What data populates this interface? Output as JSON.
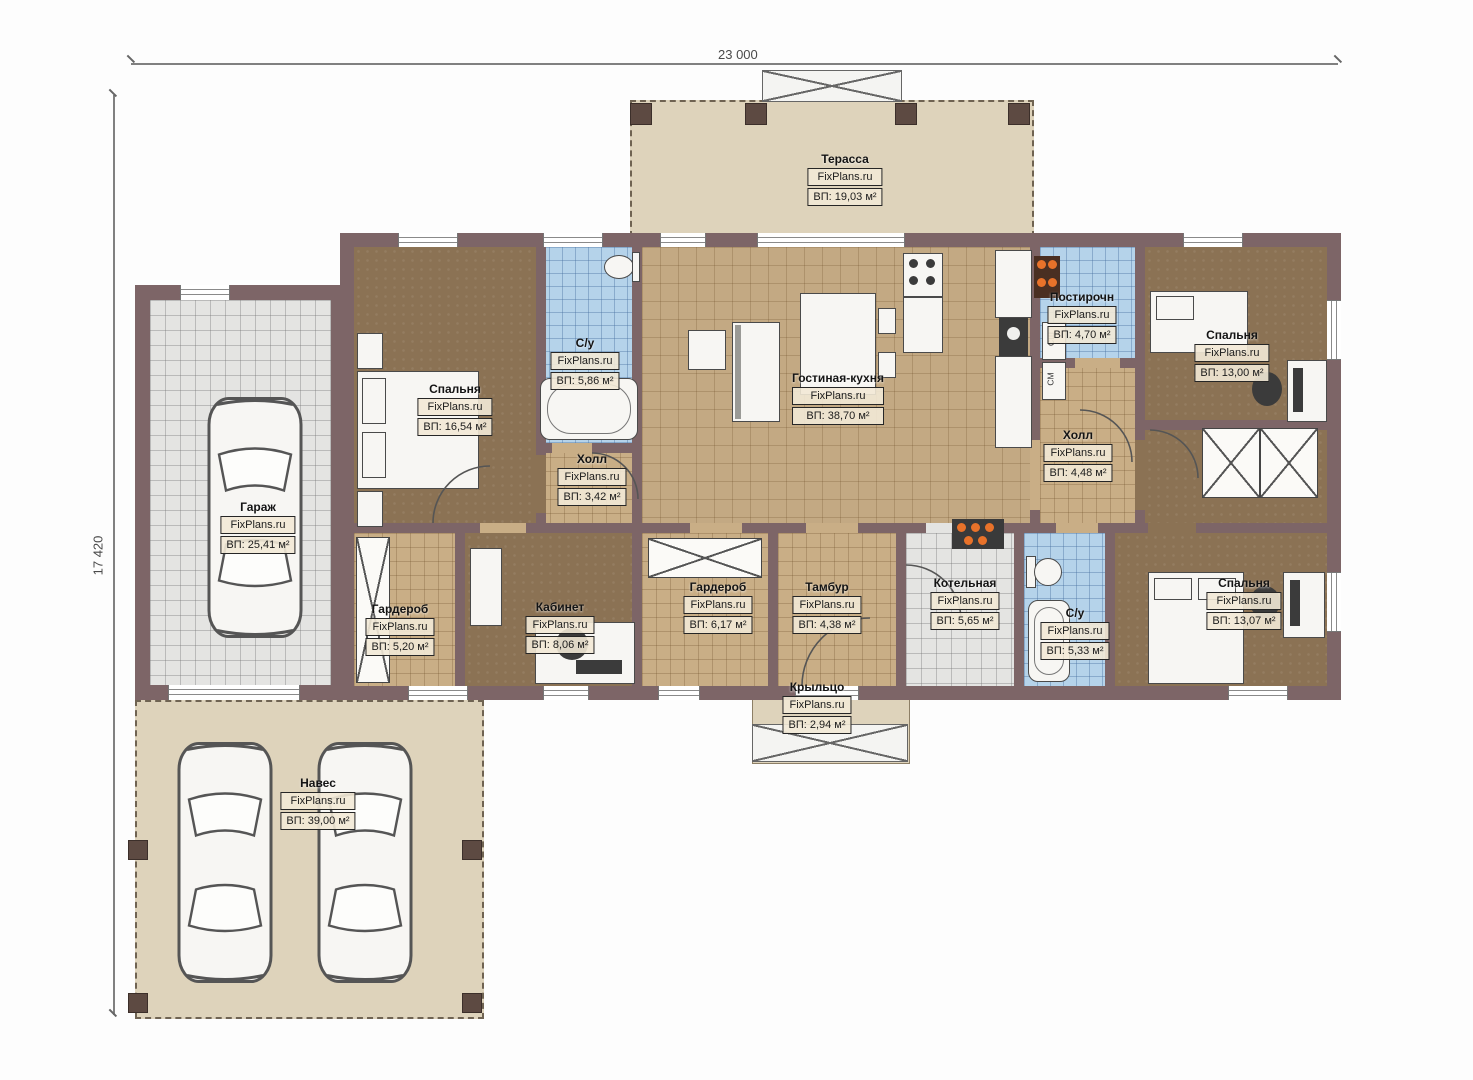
{
  "meta": {
    "watermark": "FixPlans.ru",
    "width_dimension": "23 000",
    "height_dimension": "17 420"
  },
  "rooms": [
    {
      "id": "terrace",
      "name": "Терасса",
      "area": "ВП: 19,03 м²"
    },
    {
      "id": "bedroom-left",
      "name": "Спальня",
      "area": "ВП: 16,54 м²"
    },
    {
      "id": "bathroom-top",
      "name": "С/у",
      "area": "ВП: 5,86 м²"
    },
    {
      "id": "hall-left",
      "name": "Холл",
      "area": "ВП: 3,42 м²"
    },
    {
      "id": "living-kitchen",
      "name": "Гостиная-кухня",
      "area": "ВП: 38,70 м²"
    },
    {
      "id": "laundry",
      "name": "Постирочн",
      "area": "ВП: 4,70 м²"
    },
    {
      "id": "bedroom-top-right",
      "name": "Спальня",
      "area": "ВП: 13,00 м²"
    },
    {
      "id": "hall-right",
      "name": "Холл",
      "area": "ВП: 4,48 м²"
    },
    {
      "id": "garage",
      "name": "Гараж",
      "area": "ВП: 25,41 м²"
    },
    {
      "id": "wardrobe-left",
      "name": "Гардероб",
      "area": "ВП: 5,20 м²"
    },
    {
      "id": "office",
      "name": "Кабинет",
      "area": "ВП: 8,06 м²"
    },
    {
      "id": "wardrobe-center",
      "name": "Гардероб",
      "area": "ВП: 6,17 м²"
    },
    {
      "id": "vestibule",
      "name": "Тамбур",
      "area": "ВП: 4,38 м²"
    },
    {
      "id": "boiler-room",
      "name": "Котельная",
      "area": "ВП: 5,65 м²"
    },
    {
      "id": "bathroom-bottom",
      "name": "С/у",
      "area": "ВП: 5,33 м²"
    },
    {
      "id": "bedroom-bottom-right",
      "name": "Спальня",
      "area": "ВП: 13,07 м²"
    },
    {
      "id": "porch",
      "name": "Крыльцо",
      "area": "ВП: 2,94 м²"
    },
    {
      "id": "canopy",
      "name": "Навес",
      "area": "ВП: 39,00 м²"
    }
  ],
  "appliances": {
    "dryer": "СШ",
    "washer": "СМ"
  },
  "colors": {
    "wall": "#7d6567",
    "floor_wood": "#8b7254",
    "floor_tile_tan": "#c9ae86",
    "floor_tile_blue": "#b5d3ea",
    "floor_tile_gray": "#e4e4e2",
    "outdoor": "#ded3bb",
    "burner_accent": "#e8722a"
  }
}
